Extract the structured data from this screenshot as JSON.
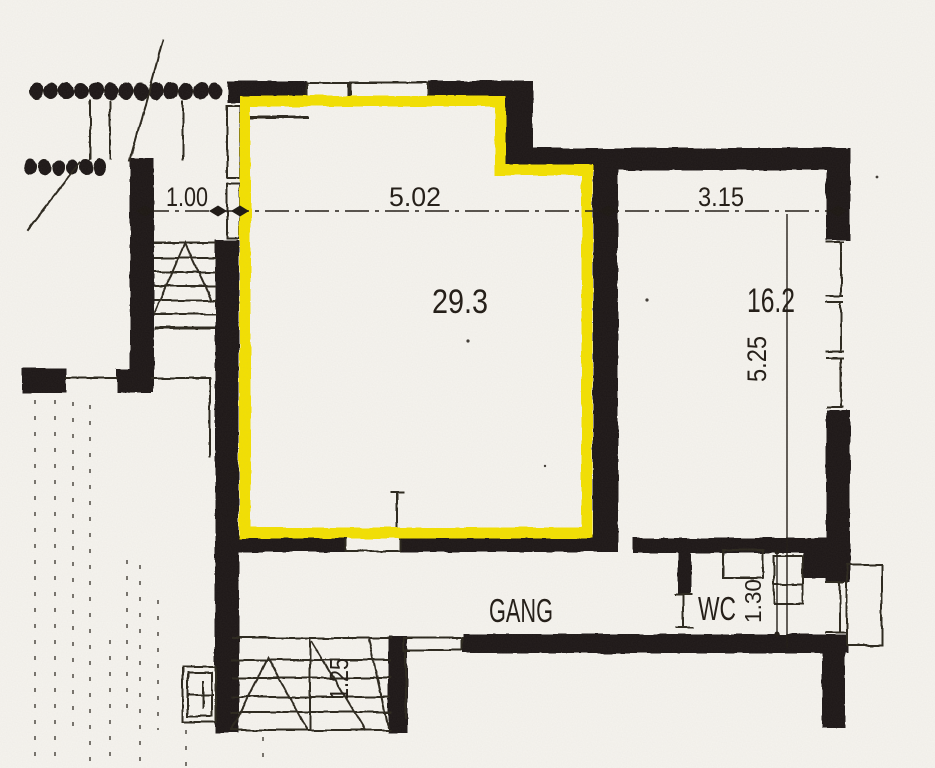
{
  "document": {
    "type": "scanned-floor-plan",
    "highlighted_room": "29.3"
  },
  "colors": {
    "highlight": "#f4e104",
    "wall": "#1b1612",
    "paper": "#f6f4ef",
    "line": "#2c261f",
    "ink": "#201a14"
  },
  "labels": {
    "dim_1_00": "1.00",
    "dim_5_02": "5.02",
    "dim_3_15": "3.15",
    "dim_5_25": "5.25",
    "dim_1_30": "1.30",
    "dim_1_25": "1.25",
    "area_main": "29.3",
    "area_right": "16.2",
    "room_corridor": "GANG",
    "room_wc": "WC"
  },
  "rooms": [
    {
      "name": "main room",
      "area_m2": "29.3",
      "width_m": "5.02",
      "highlighted": true
    },
    {
      "name": "right room",
      "area_m2": "16.2",
      "width_m": "3.15",
      "depth_m": "5.25"
    },
    {
      "name": "corridor",
      "label": "GANG"
    },
    {
      "name": "toilet",
      "label": "WC",
      "width_m": "1.30"
    },
    {
      "name": "stair",
      "width_m": "1.25"
    },
    {
      "name": "entry",
      "width_m": "1.00"
    }
  ]
}
